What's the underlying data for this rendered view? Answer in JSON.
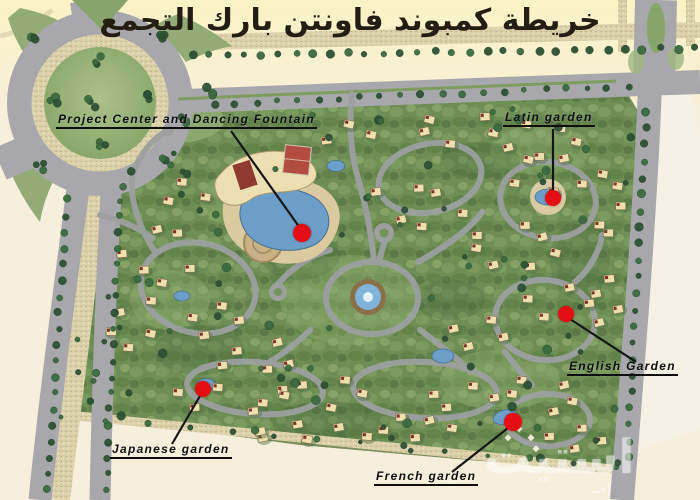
{
  "title": "خريطة كمبوند فاونتن بارك التجمع",
  "watermark": {
    "text": "استيت",
    "subtext": "إخـ"
  },
  "colors": {
    "accent_red": "#e30f15",
    "label_black": "#0e0e0e",
    "title_color": "#241d12",
    "background": "#f6efdc",
    "top_band": "#fbf3c5",
    "road_gray": "#a8a8ac",
    "sand": "#dbd2ab",
    "grass_green": "#6f8e55",
    "water_blue": "#6d9ec7",
    "watermark_white": "#ffffff"
  },
  "map": {
    "markers": [
      {
        "id": "project-center",
        "label": "Project Center and  Dancing Fountain",
        "label_x": 56,
        "label_y": 112,
        "dot_x": 302,
        "dot_y": 233,
        "dot_r": 9,
        "line": [
          231,
          131,
          300,
          228
        ]
      },
      {
        "id": "latin-garden",
        "label": "Latin garden",
        "label_x": 503,
        "label_y": 110,
        "dot_x": 553,
        "dot_y": 198,
        "dot_r": 8,
        "line": [
          553,
          129,
          553,
          192
        ]
      },
      {
        "id": "english-garden",
        "label": "English Garden",
        "label_x": 567,
        "label_y": 359,
        "dot_x": 566,
        "dot_y": 314,
        "dot_r": 8,
        "line": [
          570,
          319,
          636,
          362
        ]
      },
      {
        "id": "japanese-garden",
        "label": "Japanese garden",
        "label_x": 110,
        "label_y": 442,
        "dot_x": 203,
        "dot_y": 389,
        "dot_r": 8,
        "line": [
          200,
          396,
          172,
          444
        ]
      },
      {
        "id": "french-garden",
        "label": "French garden",
        "label_x": 374,
        "label_y": 469,
        "dot_x": 513,
        "dot_y": 422,
        "dot_r": 9,
        "line": [
          508,
          428,
          452,
          472
        ]
      }
    ]
  }
}
